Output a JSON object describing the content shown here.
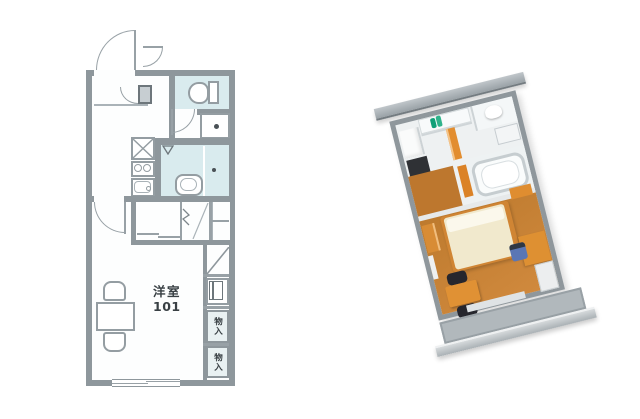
{
  "page": {
    "background": "#ffffff"
  },
  "plan2d": {
    "name": "2D floor plan",
    "room_label": {
      "line1": "洋室",
      "line2": "101"
    },
    "storage_labels": [
      "物入",
      "物入"
    ],
    "colors": {
      "wall": "#8e979c",
      "wet_area_floor": "#d9ebee",
      "floor": "#fdfefe",
      "fixture_line": "#949da2",
      "text": "#394044"
    },
    "fixtures": [
      "entrance-door",
      "toilet",
      "washing-machine-space",
      "gas-stove",
      "two-burner-cooktop",
      "kitchen-sink",
      "bathtub",
      "shower-mark",
      "room-door",
      "sliding-closet",
      "folding-closet",
      "shelf",
      "window",
      "storage-box",
      "storage-box",
      "dining-table",
      "chair",
      "chair"
    ]
  },
  "plan3d": {
    "name": "3D isometric floor plan",
    "rotation_deg": -14,
    "colors": {
      "outer_wall": "#8f979c",
      "eave_bar": "#a9b0b5",
      "wood_floor": "#bd7a2e",
      "wood_floor_light": "#d18a3e",
      "accent_orange": "#e08e30",
      "bed_mattress": "#f1e9cd",
      "pillow": "#fbf8ec",
      "dark_chair": "#26262d",
      "blue_chair": "#5a76b5",
      "counter_dark": "#2f3135",
      "teal_bottle": "#12a07b",
      "bath_white": "#fafcfc",
      "balcony": "#b1b8bc"
    },
    "furniture": [
      "shoe-cabinet",
      "kitchen-counter",
      "teal-bottles",
      "toilet",
      "washing-machine",
      "bathtub",
      "bed",
      "desk",
      "desk-chair",
      "dining-table",
      "dark-chairs",
      "shelf",
      "balcony"
    ]
  }
}
